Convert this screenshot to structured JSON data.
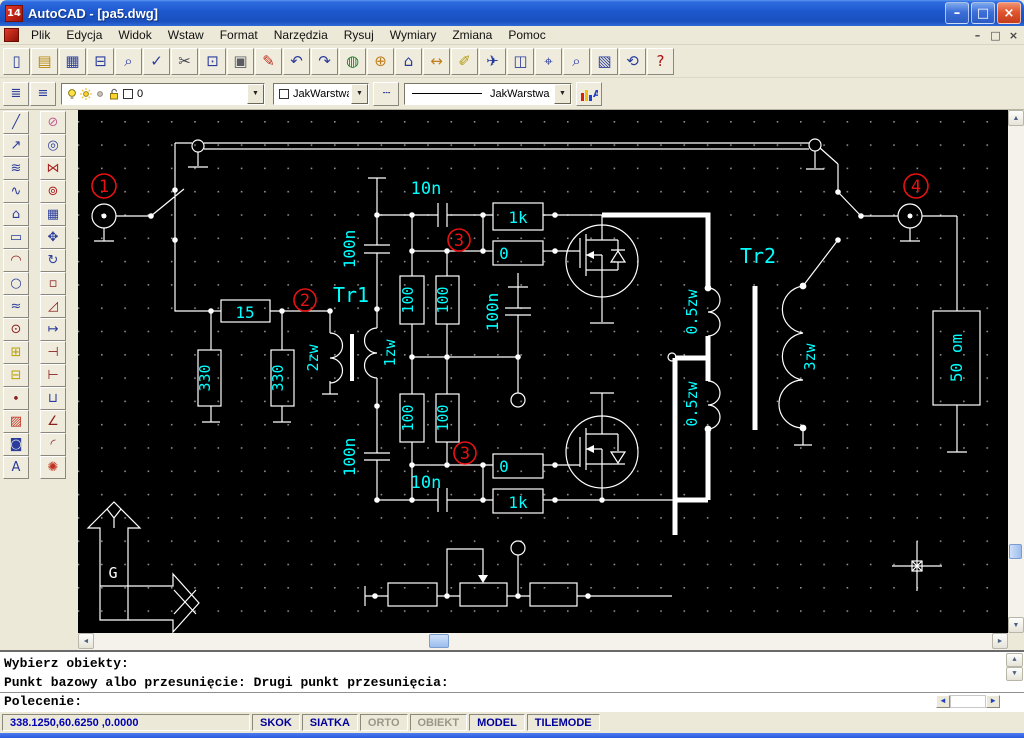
{
  "window": {
    "title": "AutoCAD - [pa5.dwg]",
    "logo_text": "14",
    "min_glyph": "–",
    "restore_glyph": "□",
    "close_glyph": "×"
  },
  "mdi": {
    "min_glyph": "–",
    "restore_glyph": "□",
    "close_glyph": "×"
  },
  "menu": {
    "items": [
      "Plik",
      "Edycja",
      "Widok",
      "Wstaw",
      "Format",
      "Narzędzia",
      "Rysuj",
      "Wymiary",
      "Zmiana",
      "Pomoc"
    ]
  },
  "toolbar_standard": [
    {
      "name": "new-file-button",
      "glyph": "▯",
      "color": "#2a3c9c"
    },
    {
      "name": "open-folder-button",
      "glyph": "▤",
      "color": "#b8860b"
    },
    {
      "name": "save-button",
      "glyph": "▦",
      "color": "#2a3c9c"
    },
    {
      "name": "print-button",
      "glyph": "⊟",
      "color": "#2a3c9c"
    },
    {
      "name": "print-preview-button",
      "glyph": "⌕",
      "color": "#2a3c9c"
    },
    {
      "name": "spell-check-button",
      "glyph": "✓",
      "color": "#2a3c9c"
    },
    {
      "name": "cut-button",
      "glyph": "✂",
      "color": "#40424c"
    },
    {
      "name": "copy-button",
      "glyph": "⊡",
      "color": "#2a3c9c"
    },
    {
      "name": "paste-button",
      "glyph": "▣",
      "color": "#5a5c66"
    },
    {
      "name": "match-properties-button",
      "glyph": "✎",
      "color": "#c03020"
    },
    {
      "name": "undo-button",
      "glyph": "↶",
      "color": "#2a3c9c"
    },
    {
      "name": "redo-button",
      "glyph": "↷",
      "color": "#2a3c9c"
    },
    {
      "name": "launch-browser-button",
      "glyph": "◍",
      "color": "#1a7a2a"
    },
    {
      "name": "object-snap-button",
      "glyph": "⊕",
      "color": "#c08020"
    },
    {
      "name": "ucs-button",
      "glyph": "⌂",
      "color": "#2a3c9c"
    },
    {
      "name": "distance-button",
      "glyph": "↔",
      "color": "#c08020"
    },
    {
      "name": "redline-button",
      "glyph": "✐",
      "color": "#b09a10"
    },
    {
      "name": "named-views-button",
      "glyph": "✈",
      "color": "#2a3c9c"
    },
    {
      "name": "aerial-view-button",
      "glyph": "◫",
      "color": "#2a3c9c"
    },
    {
      "name": "pan-realtime-button",
      "glyph": "⌖",
      "color": "#2a3c9c"
    },
    {
      "name": "zoom-realtime-button",
      "glyph": "⌕",
      "color": "#2a3c9c"
    },
    {
      "name": "zoom-window-button",
      "glyph": "▧",
      "color": "#2a3c9c"
    },
    {
      "name": "zoom-previous-button",
      "glyph": "⟲",
      "color": "#2a3c9c"
    },
    {
      "name": "help-button",
      "glyph": "?",
      "color": "#aa1111"
    }
  ],
  "toolbar_properties": {
    "make_layer_glyph": "≣",
    "layers_glyph": "≡",
    "layer_value": "0",
    "color_value": "JakWarstwa",
    "linetype_glyph": "┄",
    "linetype_value": "JakWarstwa",
    "props_label": "A"
  },
  "toolbox_draw": [
    {
      "name": "line-tool",
      "glyph": "╱",
      "color": "#2a3c9c"
    },
    {
      "name": "construction-line-tool",
      "glyph": "↗",
      "color": "#2a3c9c"
    },
    {
      "name": "multiline-tool",
      "glyph": "≋",
      "color": "#2a3c9c"
    },
    {
      "name": "polyline-tool",
      "glyph": "∿",
      "color": "#2a3c9c"
    },
    {
      "name": "polygon-tool",
      "glyph": "⌂",
      "color": "#2a3c9c"
    },
    {
      "name": "rectangle-tool",
      "glyph": "▭",
      "color": "#2a3c9c"
    },
    {
      "name": "arc-tool",
      "glyph": "◠",
      "color": "#8a2020"
    },
    {
      "name": "circle-tool",
      "glyph": "○",
      "color": "#2a3c9c"
    },
    {
      "name": "spline-tool",
      "glyph": "≈",
      "color": "#2a3c9c"
    },
    {
      "name": "ellipse-tool",
      "glyph": "⊙",
      "color": "#8a2020"
    },
    {
      "name": "insert-block-tool",
      "glyph": "⊞",
      "color": "#b8a000"
    },
    {
      "name": "make-block-tool",
      "glyph": "⊟",
      "color": "#b8a000"
    },
    {
      "name": "point-tool",
      "glyph": "∙",
      "color": "#8a2020"
    },
    {
      "name": "hatch-tool",
      "glyph": "▨",
      "color": "#c03020"
    },
    {
      "name": "region-tool",
      "glyph": "◙",
      "color": "#2a3c9c"
    },
    {
      "name": "text-tool",
      "glyph": "A",
      "color": "#2a3c9c"
    }
  ],
  "toolbox_modify": [
    {
      "name": "erase-tool",
      "glyph": "⊘",
      "color": "#c06090"
    },
    {
      "name": "copy-object-tool",
      "glyph": "◎",
      "color": "#2a3c9c"
    },
    {
      "name": "mirror-tool",
      "glyph": "⋈",
      "color": "#aa2222"
    },
    {
      "name": "offset-tool",
      "glyph": "⊚",
      "color": "#aa2222"
    },
    {
      "name": "array-tool",
      "glyph": "▦",
      "color": "#2a3c9c"
    },
    {
      "name": "move-tool",
      "glyph": "✥",
      "color": "#2a3c9c"
    },
    {
      "name": "rotate-tool",
      "glyph": "↻",
      "color": "#2a3c9c"
    },
    {
      "name": "scale-tool",
      "glyph": "▫",
      "color": "#8a2020"
    },
    {
      "name": "stretch-tool",
      "glyph": "◿",
      "color": "#8a2020"
    },
    {
      "name": "lengthen-tool",
      "glyph": "↦",
      "color": "#2a3c9c"
    },
    {
      "name": "trim-tool",
      "glyph": "⊣",
      "color": "#8a2020"
    },
    {
      "name": "extend-tool",
      "glyph": "⊢",
      "color": "#8a2020"
    },
    {
      "name": "break-tool",
      "glyph": "⊔",
      "color": "#2a3c9c"
    },
    {
      "name": "chamfer-tool",
      "glyph": "∠",
      "color": "#8a2020"
    },
    {
      "name": "fillet-tool",
      "glyph": "◜",
      "color": "#8a2020"
    },
    {
      "name": "explode-tool",
      "glyph": "✺",
      "color": "#c03020"
    }
  ],
  "schematic": {
    "tr1": "Tr1",
    "tr2": "Tr2",
    "r15": "15",
    "r330": "330",
    "r100": "100",
    "c100n": "100n",
    "c10n": "10n",
    "r1k": "1k",
    "r0": "0",
    "w2zw": "2zw",
    "w1zw": "1zw",
    "w05zw": "0.5zw",
    "w3zw": "3zw",
    "r50": "50 om",
    "ucs_letter": "G",
    "markers": [
      "1",
      "2",
      "3",
      "4"
    ]
  },
  "command": {
    "history_line1": "Wybierz obiekty:",
    "history_line2": "Punkt bazowy albo przesunięcie: Drugi punkt przesunięcia:",
    "prompt": "Polecenie:"
  },
  "status": {
    "coordinates": "338.1250,60.6250 ,0.0000",
    "toggles": [
      {
        "label": "SKOK",
        "active": true
      },
      {
        "label": "SIATKA",
        "active": true
      },
      {
        "label": "ORTO",
        "active": false
      },
      {
        "label": "OBIEKT",
        "active": false
      },
      {
        "label": "MODEL",
        "active": true
      },
      {
        "label": "TILEMODE",
        "active": true
      }
    ]
  },
  "icons": {
    "scroll_up": "▲",
    "scroll_down": "▼",
    "scroll_left": "◄",
    "scroll_right": "►",
    "combo_arrow": "▼"
  }
}
